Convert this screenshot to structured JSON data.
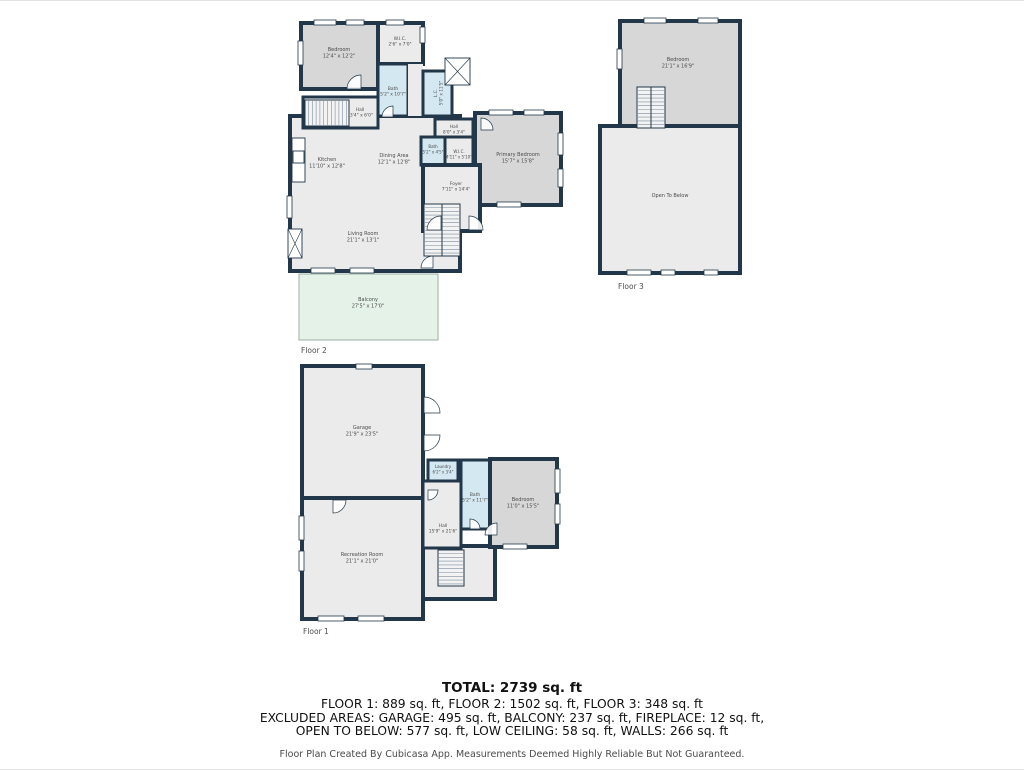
{
  "palette": {
    "wall": "#223749",
    "floor": "#ebebeb",
    "bed": "#d7d7d7",
    "wet": "#d3e8f0",
    "balcony": "#e4f2e8",
    "stair_fill": "#f3f3f3",
    "step_line": "#7d8da0",
    "label": "#4a4a4a",
    "caption": "#4d4d4d",
    "balcony_stroke": "#9bb2a6"
  },
  "floorplans": [
    {
      "id": "floor-2-plan",
      "caption": "Floor 2",
      "caption_xy": [
        301,
        352
      ],
      "shapes": [
        {
          "type": "room",
          "name": "main-living-area",
          "fill": "floor",
          "rect": [
            290,
            115,
            170,
            155
          ],
          "sw": 4
        },
        {
          "type": "room",
          "name": "bedroom-f2",
          "fill": "bed",
          "rect": [
            301,
            22,
            77,
            66
          ],
          "sw": 4,
          "label": {
            "lines": [
              "Bedroom",
              "12'4\" x 12'2\""
            ],
            "xy": [
              339,
              50
            ]
          }
        },
        {
          "type": "room",
          "name": "wic-f2",
          "fill": "floor",
          "rect": [
            378,
            22,
            45,
            41
          ],
          "sw": 4,
          "label": {
            "lines": [
              "W.I.C.",
              "2'6\" x 7'0\""
            ],
            "xy": [
              400,
              39
            ],
            "fs": 4.4
          }
        },
        {
          "type": "room",
          "name": "bath-f2",
          "fill": "wet",
          "rect": [
            378,
            63,
            30,
            52
          ],
          "sw": 3,
          "label": {
            "lines": [
              "Bath",
              "5'2\" x 10'7\""
            ],
            "xy": [
              393,
              89
            ],
            "fs": 4.4
          }
        },
        {
          "type": "filler",
          "name": "hall-strip-f2",
          "fill": "floor",
          "rect": [
            408,
            63,
            15,
            52
          ]
        },
        {
          "type": "room",
          "name": "low-ceiling-f2",
          "fill": "wet",
          "rect": [
            423,
            70,
            29,
            45
          ],
          "sw": 3,
          "label": {
            "lines": [
              "L.C.",
              "5'0\" x 11'5\""
            ],
            "xy": [
              437,
              92
            ],
            "fs": 4.2,
            "rot": -90
          }
        },
        {
          "type": "room",
          "name": "hall-f2",
          "fill": "floor",
          "rect": [
            303,
            96,
            75,
            31
          ],
          "sw": 3,
          "label": {
            "lines": [
              "Hall",
              "13'4\" x 6'0\""
            ],
            "xy": [
              360,
              110
            ],
            "fs": 4.4
          }
        },
        {
          "type": "stairs",
          "name": "stairs-upper-f2",
          "rect": [
            305,
            99,
            44,
            26
          ],
          "dir": "v"
        },
        {
          "type": "room",
          "name": "hall-2-f2",
          "fill": "floor",
          "rect": [
            435,
            118,
            38,
            24
          ],
          "sw": 3,
          "label": {
            "lines": [
              "Hall",
              "8'0\" x 3'4\""
            ],
            "xy": [
              454,
              127
            ],
            "fs": 4.2
          }
        },
        {
          "type": "room",
          "name": "bath-2-f2",
          "fill": "wet",
          "rect": [
            421,
            136,
            24,
            28
          ],
          "sw": 3,
          "label": {
            "lines": [
              "Bath",
              "5'2\" x 4'5\""
            ],
            "xy": [
              433,
              147
            ],
            "fs": 4.0
          }
        },
        {
          "type": "room",
          "name": "wic-2-f2",
          "fill": "floor",
          "rect": [
            445,
            136,
            28,
            37
          ],
          "sw": 3,
          "label": {
            "lines": [
              "W.I.C.",
              "4'11\" x 5'10\""
            ],
            "xy": [
              459,
              152
            ],
            "fs": 4.0
          }
        },
        {
          "type": "room",
          "name": "primary-bedroom-f2",
          "fill": "bed",
          "rect": [
            475,
            112,
            86,
            92
          ],
          "sw": 4,
          "label": {
            "lines": [
              "Primary Bedroom",
              "15'7\" x 15'8\""
            ],
            "xy": [
              518,
              155
            ]
          }
        },
        {
          "type": "room",
          "name": "foyer-f2",
          "fill": "floor",
          "rect": [
            423,
            164,
            57,
            66
          ],
          "sw": 4,
          "label": {
            "lines": [
              "Foyer",
              "7'11\" x 14'4\""
            ],
            "xy": [
              456,
              184
            ],
            "fs": 4.4
          }
        },
        {
          "type": "stairs",
          "name": "stairs-main-f2",
          "rect": [
            424,
            203,
            36,
            52
          ],
          "dir": "h",
          "divider": "v"
        },
        {
          "type": "room",
          "name": "balcony-f2",
          "fill": "balcony",
          "rect": [
            299,
            273,
            139,
            66
          ],
          "sw": 1,
          "stroke": "balcony_stroke",
          "label": {
            "lines": [
              "Balcony",
              "27'5\" x 17'0\""
            ],
            "xy": [
              368,
              300
            ]
          }
        },
        {
          "type": "box",
          "name": "shower-f2",
          "rect": [
            445,
            57,
            25,
            27
          ],
          "cross": true
        },
        {
          "type": "box",
          "name": "fireplace-f2",
          "rect": [
            288,
            228,
            14,
            29
          ],
          "cross": true
        },
        {
          "type": "box",
          "name": "kitchen-counter-f2",
          "rect": [
            292,
            137,
            13,
            44
          ]
        },
        {
          "type": "box",
          "name": "stove-f2",
          "rect": [
            293,
            150,
            11,
            12
          ]
        },
        {
          "type": "window",
          "name": "window",
          "rect": [
            314,
            19,
            22,
            5
          ]
        },
        {
          "type": "window",
          "name": "window",
          "rect": [
            346,
            19,
            18,
            5
          ]
        },
        {
          "type": "window",
          "name": "window",
          "rect": [
            386,
            19,
            18,
            5
          ]
        },
        {
          "type": "window",
          "name": "window",
          "rect": [
            298,
            40,
            5,
            24
          ]
        },
        {
          "type": "window",
          "name": "window",
          "rect": [
            420,
            26,
            5,
            16
          ]
        },
        {
          "type": "window",
          "name": "window",
          "rect": [
            287,
            195,
            5,
            22
          ]
        },
        {
          "type": "window",
          "name": "window",
          "rect": [
            311,
            267,
            24,
            5
          ]
        },
        {
          "type": "window",
          "name": "window",
          "rect": [
            350,
            267,
            24,
            5
          ]
        },
        {
          "type": "window",
          "name": "window",
          "rect": [
            489,
            109,
            24,
            5
          ]
        },
        {
          "type": "window",
          "name": "window",
          "rect": [
            524,
            109,
            20,
            5
          ]
        },
        {
          "type": "window",
          "name": "window",
          "rect": [
            558,
            132,
            5,
            22
          ]
        },
        {
          "type": "window",
          "name": "window",
          "rect": [
            558,
            168,
            5,
            18
          ]
        },
        {
          "type": "window",
          "name": "window",
          "rect": [
            497,
            201,
            24,
            5
          ]
        },
        {
          "type": "door",
          "name": "door-arc",
          "xy": [
            361,
            88
          ],
          "r": 14,
          "a0": 180,
          "a1": 270
        },
        {
          "type": "door",
          "name": "door-arc",
          "xy": [
            393,
            116
          ],
          "r": 11,
          "a0": 180,
          "a1": 270
        },
        {
          "type": "door",
          "name": "door-arc",
          "xy": [
            481,
            129
          ],
          "r": 12,
          "a0": 270,
          "a1": 360
        },
        {
          "type": "door",
          "name": "door-arc",
          "xy": [
            441,
            229
          ],
          "r": 14,
          "a0": 180,
          "a1": 270
        },
        {
          "type": "door",
          "name": "door-arc",
          "xy": [
            469,
            229
          ],
          "r": 14,
          "a0": 270,
          "a1": 360
        },
        {
          "type": "door",
          "name": "door-arc",
          "xy": [
            433,
            267
          ],
          "r": 12,
          "a0": 180,
          "a1": 270
        },
        {
          "type": "label",
          "name": "kitchen-label",
          "lines": [
            "Kitchen",
            "11'10\" x 12'8\""
          ],
          "xy": [
            327,
            160
          ]
        },
        {
          "type": "label",
          "name": "dining-area-label",
          "lines": [
            "Dining Area",
            "12'1\" x 12'8\""
          ],
          "xy": [
            394,
            156
          ]
        },
        {
          "type": "label",
          "name": "living-room-label",
          "lines": [
            "Living Room",
            "21'1\" x 13'1\""
          ],
          "xy": [
            363,
            234
          ]
        }
      ]
    },
    {
      "id": "floor-3-plan",
      "caption": "Floor 3",
      "caption_xy": [
        618,
        288
      ],
      "shapes": [
        {
          "type": "room",
          "name": "bedroom-f3",
          "fill": "bed",
          "rect": [
            620,
            20,
            120,
            108
          ],
          "sw": 4,
          "label": {
            "lines": [
              "Bedroom",
              "21'1\" x 16'9\""
            ],
            "xy": [
              678,
              60
            ]
          }
        },
        {
          "type": "room",
          "name": "open-to-below-f3",
          "fill": "floor",
          "rect": [
            600,
            125,
            140,
            147
          ],
          "sw": 4,
          "label": {
            "lines": [
              "Open To Below"
            ],
            "xy": [
              670,
              196
            ]
          }
        },
        {
          "type": "stairs",
          "name": "stairs-f3",
          "rect": [
            637,
            86,
            28,
            41
          ],
          "dir": "h",
          "divider": "v"
        },
        {
          "type": "window",
          "name": "window",
          "rect": [
            644,
            17,
            22,
            5
          ]
        },
        {
          "type": "window",
          "name": "window",
          "rect": [
            698,
            17,
            20,
            5
          ]
        },
        {
          "type": "window",
          "name": "window",
          "rect": [
            617,
            48,
            5,
            20
          ]
        },
        {
          "type": "window",
          "name": "window",
          "rect": [
            627,
            269,
            24,
            5
          ]
        },
        {
          "type": "window",
          "name": "window",
          "rect": [
            661,
            269,
            14,
            5
          ]
        },
        {
          "type": "window",
          "name": "window",
          "rect": [
            704,
            269,
            14,
            5
          ]
        }
      ]
    },
    {
      "id": "floor-1-plan",
      "caption": "Floor 1",
      "caption_xy": [
        303,
        633
      ],
      "shapes": [
        {
          "type": "room",
          "name": "garage-f1",
          "fill": "floor",
          "rect": [
            302,
            365,
            121,
            132
          ],
          "sw": 4,
          "label": {
            "lines": [
              "Garage",
              "21'9\" x 23'5\""
            ],
            "xy": [
              362,
              428
            ]
          }
        },
        {
          "type": "room",
          "name": "recreation-room-f1",
          "fill": "floor",
          "rect": [
            302,
            497,
            121,
            121
          ],
          "sw": 4,
          "label": {
            "lines": [
              "Recreation Room",
              "21'1\" x 21'0\""
            ],
            "xy": [
              362,
              555
            ]
          }
        },
        {
          "type": "room",
          "name": "stair-area-f1",
          "fill": "floor",
          "rect": [
            423,
            545,
            72,
            53
          ],
          "sw": 4
        },
        {
          "type": "room",
          "name": "hall-f1",
          "fill": "floor",
          "rect": [
            423,
            480,
            38,
            67
          ],
          "sw": 3,
          "label": {
            "lines": [
              "Hall",
              "15'9\" x 21'6\""
            ],
            "xy": [
              443,
              526
            ],
            "fs": 4.4
          }
        },
        {
          "type": "room",
          "name": "laundry-f1",
          "fill": "wet",
          "rect": [
            428,
            459,
            30,
            21
          ],
          "sw": 3,
          "label": {
            "lines": [
              "Laundry",
              "6'2\" x 3'4\""
            ],
            "xy": [
              443,
              467
            ],
            "fs": 4.0
          }
        },
        {
          "type": "room",
          "name": "bath-f1",
          "fill": "wet",
          "rect": [
            461,
            459,
            29,
            69
          ],
          "sw": 3,
          "label": {
            "lines": [
              "Bath",
              "5'2\" x 11'7\""
            ],
            "xy": [
              475,
              495
            ],
            "fs": 4.4
          }
        },
        {
          "type": "room",
          "name": "bedroom-f1",
          "fill": "bed",
          "rect": [
            490,
            458,
            67,
            88
          ],
          "sw": 4,
          "label": {
            "lines": [
              "Bedroom",
              "11'0\" x 15'5\""
            ],
            "xy": [
              523,
              500
            ]
          }
        },
        {
          "type": "stairs",
          "name": "stairs-f1",
          "rect": [
            438,
            549,
            26,
            36
          ],
          "dir": "h"
        },
        {
          "type": "window",
          "name": "window",
          "rect": [
            299,
            515,
            5,
            24
          ]
        },
        {
          "type": "window",
          "name": "window",
          "rect": [
            299,
            550,
            5,
            20
          ]
        },
        {
          "type": "window",
          "name": "window",
          "rect": [
            318,
            615,
            26,
            5
          ]
        },
        {
          "type": "window",
          "name": "window",
          "rect": [
            358,
            615,
            26,
            5
          ]
        },
        {
          "type": "window",
          "name": "window",
          "rect": [
            555,
            468,
            5,
            24
          ]
        },
        {
          "type": "window",
          "name": "window",
          "rect": [
            555,
            503,
            5,
            20
          ]
        },
        {
          "type": "window",
          "name": "window",
          "rect": [
            503,
            543,
            24,
            5
          ]
        },
        {
          "type": "window",
          "name": "window",
          "rect": [
            356,
            363,
            16,
            5
          ]
        },
        {
          "type": "door",
          "name": "garage-door-arc",
          "xy": [
            424,
            412
          ],
          "r": 16,
          "a0": 270,
          "a1": 360
        },
        {
          "type": "door",
          "name": "garage-door-arc",
          "xy": [
            424,
            434
          ],
          "r": 16,
          "a0": 0,
          "a1": 90
        },
        {
          "type": "door",
          "name": "door-arc",
          "xy": [
            333,
            499
          ],
          "r": 13,
          "a0": 0,
          "a1": 90
        },
        {
          "type": "door",
          "name": "door-arc",
          "xy": [
            497,
            534
          ],
          "r": 12,
          "a0": 180,
          "a1": 270
        },
        {
          "type": "door",
          "name": "door-arc",
          "xy": [
            470,
            528
          ],
          "r": 10,
          "a0": 270,
          "a1": 360
        },
        {
          "type": "door",
          "name": "door-arc",
          "xy": [
            428,
            489
          ],
          "r": 10,
          "a0": 0,
          "a1": 90
        }
      ]
    }
  ],
  "summary": {
    "total": "TOTAL: 2739 sq. ft",
    "lines": [
      "FLOOR 1: 889 sq. ft, FLOOR 2: 1502 sq. ft, FLOOR 3: 348 sq. ft",
      "EXCLUDED AREAS: GARAGE: 495 sq. ft, BALCONY: 237 sq. ft, FIREPLACE: 12 sq. ft,",
      "OPEN TO BELOW: 577 sq. ft, LOW CEILING: 58 sq. ft, WALLS: 266 sq. ft"
    ],
    "disclaimer": "Floor Plan Created By Cubicasa App. Measurements Deemed Highly Reliable But Not Guaranteed."
  }
}
